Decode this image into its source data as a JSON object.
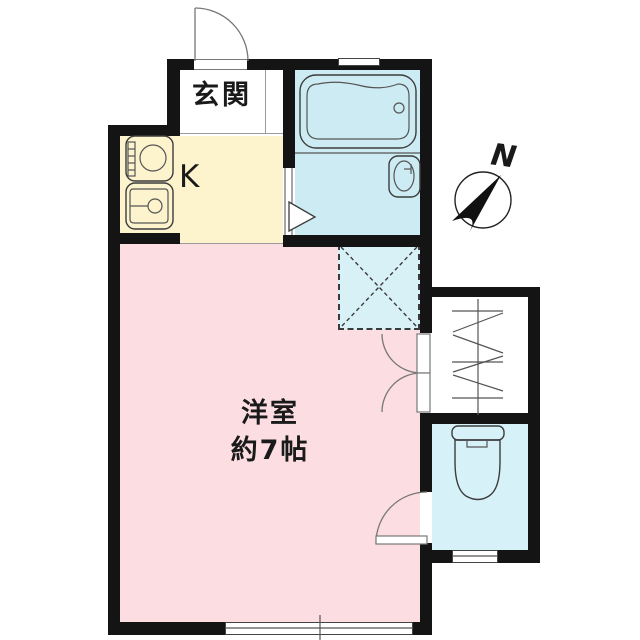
{
  "labels": {
    "genkan": "玄関",
    "kitchen": "K",
    "room_name": "洋室",
    "room_size": "約7帖",
    "compass_north": "N"
  },
  "colors": {
    "wall": "#141414",
    "room-pink": "#fbdde2",
    "kitchen-yellow": "#fdf3cd",
    "bath-cyan": "#cdebf3",
    "toilet-cyan": "#d7f1f8",
    "washing-cyan": "#d8f1f7"
  }
}
